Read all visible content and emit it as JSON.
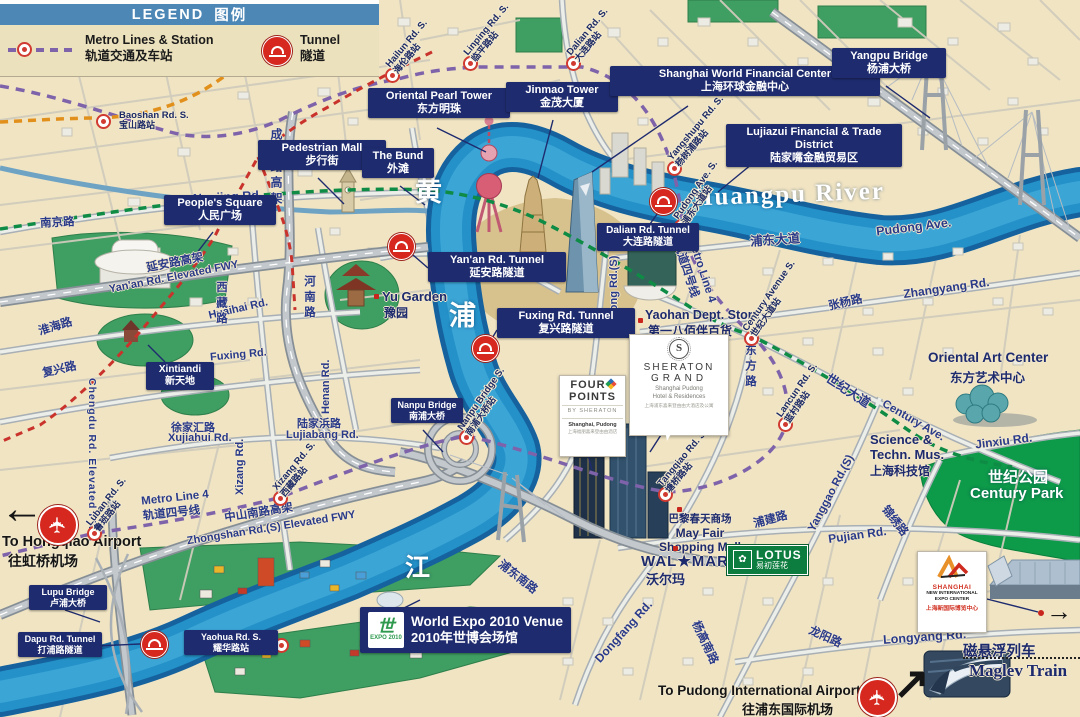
{
  "legend": {
    "title_en": "LEGEND",
    "title_cn": "图例",
    "metro_en": "Metro Lines & Station",
    "metro_cn": "轨道交通及车站",
    "tunnel_en": "Tunnel",
    "tunnel_cn": "隧道"
  },
  "colors": {
    "label_navy": "#1e2b6e",
    "legend_blue": "#4d87b5",
    "river_blue": "#2491c8",
    "line4_purple": "#7e63ab",
    "line2_green": "#0e8c45",
    "line1_red": "#c9332b",
    "line3_orange": "#e2901c",
    "tunnel_red": "#d6281e",
    "park_green": "#3f9e62"
  },
  "river": {
    "name": "Huangpu River",
    "char1": "黄",
    "char2": "浦",
    "char3": "江"
  },
  "boxes": [
    {
      "en": "Oriental Pearl Tower",
      "cn": "东方明珠"
    },
    {
      "en": "Jinmao Tower",
      "cn": "金茂大厦"
    },
    {
      "en": "Shanghai World Financial Center",
      "cn": "上海环球金融中心"
    },
    {
      "en": "Lujiazui Financial & Trade District",
      "cn": "陆家嘴金融贸易区"
    },
    {
      "en": "Yangpu Bridge",
      "cn": "杨浦大桥"
    },
    {
      "en": "Pedestrian Mall",
      "cn": "步行街"
    },
    {
      "en": "People's Square",
      "cn": "人民广场"
    },
    {
      "en": "The Bund",
      "cn": "外滩"
    },
    {
      "en": "Yan'an Rd. Tunnel",
      "cn": "延安路隧道"
    },
    {
      "en": "Fuxing Rd. Tunnel",
      "cn": "复兴路隧道"
    },
    {
      "en": "Dalian Rd. Tunnel",
      "cn": "大连路隧道"
    },
    {
      "en": "Nanpu Bridge",
      "cn": "南浦大桥"
    },
    {
      "en": "Lupu Bridge",
      "cn": "卢浦大桥"
    },
    {
      "en": "Dapu Rd. Tunnel",
      "cn": "打浦路隧道"
    },
    {
      "en": "Xintiandi",
      "cn": "新天地"
    },
    {
      "en": "Yaohua Rd. S.",
      "cn": "耀华路站"
    },
    {
      "en": "World Expo 2010 Venue",
      "cn": "2010年世博会场馆"
    }
  ],
  "stations": [
    {
      "en": "Baoshan Rd. S.",
      "cn": "宝山路站"
    },
    {
      "en": "Hailun Rd. S.",
      "cn": "海伦路站"
    },
    {
      "en": "Linping Rd. S.",
      "cn": "临平路站"
    },
    {
      "en": "Dalian Rd. S.",
      "cn": "大连路站"
    },
    {
      "en": "Yangshupu Rd. S.",
      "cn": "杨树浦路站"
    },
    {
      "en": "Pudong Ave. S.",
      "cn": "浦东大道站"
    },
    {
      "en": "Century Avenue S.",
      "cn": "世纪大道站"
    },
    {
      "en": "Lancun Rd. S.",
      "cn": "蓝村路站"
    },
    {
      "en": "Tangqiao Rd. S.",
      "cn": "塘桥路站"
    },
    {
      "en": "Nanpu Bridge S.",
      "cn": "南浦大桥站"
    },
    {
      "en": "Xizang Rd. S.",
      "cn": "西藏路站"
    },
    {
      "en": "Luban Rd. S.",
      "cn": "鲁班路站"
    }
  ],
  "roads": {
    "nanjing_en": "Nanjing Rd.",
    "nanjing_cn": "南京路",
    "yanan_cn": "延安路高架",
    "yanan_en": "Yan'an Rd. Elevated FWY",
    "huaihai_en": "Huaihai Rd.",
    "huaihai_cn": "淮海路",
    "fuxing_cn": "复兴路",
    "fuxing_en": "Fuxing Rd.",
    "chengdu_cn": "成都路高架",
    "chengdu_en": "Chengdu Rd. Elevated FWY.",
    "xujiahui_cn": "徐家汇路",
    "xujiahui_en": "Xujiahui Rd.",
    "lujiabang_cn": "陆家浜路",
    "lujiabang_en": "Lujiabang Rd.",
    "xizang_en": "Xizang Rd.",
    "xizang_cn": "西藏路",
    "henan_en": "Henan Rd.",
    "henan_cn": "河南路",
    "zhongshan_cn": "中山南路高架",
    "zhongshan_en": "Zhongshan Rd.(S) Elevated FWY",
    "metro4_en": "Metro Line 4",
    "metro4_cn": "轨道四号线",
    "pudongave_cn": "浦东大道",
    "pudongave_en": "Pudong Ave.",
    "zhangyang_en": "Zhangyang Rd.",
    "zhangyang_cn": "张杨路",
    "centuryave_cn": "世纪大道",
    "centuryave_en": "Century Ave.",
    "yanggao_en": "Yanggao Rd.(S)",
    "yanggaonan_cn": "杨高南路",
    "dongfang_en": "Dongfang Rd.",
    "dongfang_cn": "东方路",
    "pudongrd_en": "Pudong Rd.(S)",
    "pudongnan_cn": "浦东南路",
    "pujian_en": "Pujian Rd.",
    "pujian_cn": "浦建路",
    "jinxiu_en": "Jinxiu Rd.",
    "jinxiu_cn": "锦绣路",
    "longyang_en": "Longyang Rd.",
    "longyang_cn": "龙阳路"
  },
  "pois": {
    "yugarden_en": "Yu Garden",
    "yugarden_cn": "豫园",
    "yaohan_en": "Yaohan Dept. Store",
    "yaohan_cn": "第一八佰伴百货",
    "mayfair_cn": "巴黎春天商场",
    "mayfair_l1": "May Fair",
    "mayfair_l2": "Shopping Mall",
    "walmart_en": "WAL★MART",
    "walmart_cn": "沃尔玛",
    "lotus_en": "LOTUS",
    "lotus_cn": "易初莲花",
    "orientalart_en": "Oriental Art Center",
    "orientalart_cn": "东方艺术中心",
    "science_l1": "Science &",
    "science_l2": "Techn. Mus.",
    "science_cn": "上海科技馆",
    "centurypark_cn": "世纪公园",
    "centurypark_en": "Century Park",
    "maglev_cn": "磁悬浮列车",
    "maglev_en": "Maglev Train"
  },
  "brands": {
    "fourpoints": {
      "l1": "FOUR",
      "l2": "POINTS",
      "sub": "BY SHERATON",
      "loc": "Shanghai, Pudong",
      "cn": "上海福朋喜来登由由酒店"
    },
    "sheraton": {
      "mono": "S",
      "l1": "SHERATON",
      "l2": "GRAND",
      "sub1": "Shanghai Pudong",
      "sub2": "Hotel & Residences",
      "cn": "上海浦东喜来登由由大酒店及公寓"
    },
    "expo": {
      "glyph": "世",
      "l1": "EXPO",
      "l2": "2010"
    },
    "sniec": {
      "l1": "SHANGHAI",
      "l2": "NEW INTERNATIONAL",
      "l3": "EXPO CENTER",
      "cn": "上海新国际博览中心"
    }
  },
  "airports": {
    "hongqiao_en": "To Hongqiao Airport",
    "hongqiao_cn": "往虹桥机场",
    "pudong_en": "To Pudong International Airport",
    "pudong_cn": "往浦东国际机场"
  }
}
